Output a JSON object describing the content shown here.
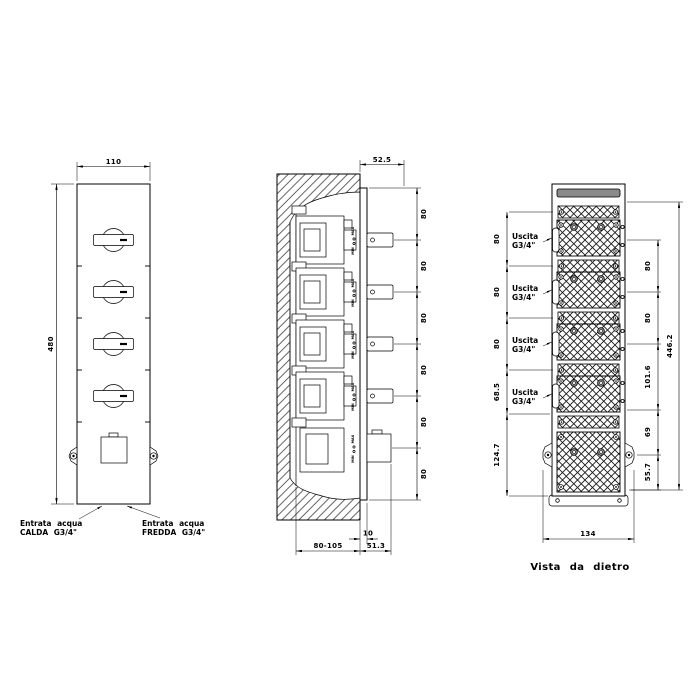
{
  "views": {
    "front": {
      "dims": {
        "width": "110",
        "height": "480"
      },
      "labels": {
        "hot_line1": "Entrata acqua",
        "hot_line2": "CALDA G3/4\"",
        "cold_line1": "Entrata acqua",
        "cold_line2": "FREDDA G3/4\""
      }
    },
    "section": {
      "dims": {
        "offset": "52.5",
        "spacing": [
          "80",
          "80",
          "80",
          "80",
          "80",
          "80"
        ],
        "plate": "10",
        "recess": "80-105",
        "protrusion": "51.3"
      },
      "labels": {
        "max": "MAX",
        "min": "MIN"
      }
    },
    "rear": {
      "outlet_label_line1": "Uscita",
      "outlet_label_line2": "G3/4\"",
      "dims": {
        "left": [
          "80",
          "80",
          "80",
          "68.5",
          "124.7"
        ],
        "right": [
          "80",
          "80",
          "101.6",
          "69",
          "55.7"
        ],
        "overall": "446.2",
        "width": "134"
      },
      "caption": "Vista da dietro"
    }
  },
  "colors": {
    "line": "#000000",
    "background": "#ffffff",
    "panel_gray": "#8a8a8a"
  }
}
